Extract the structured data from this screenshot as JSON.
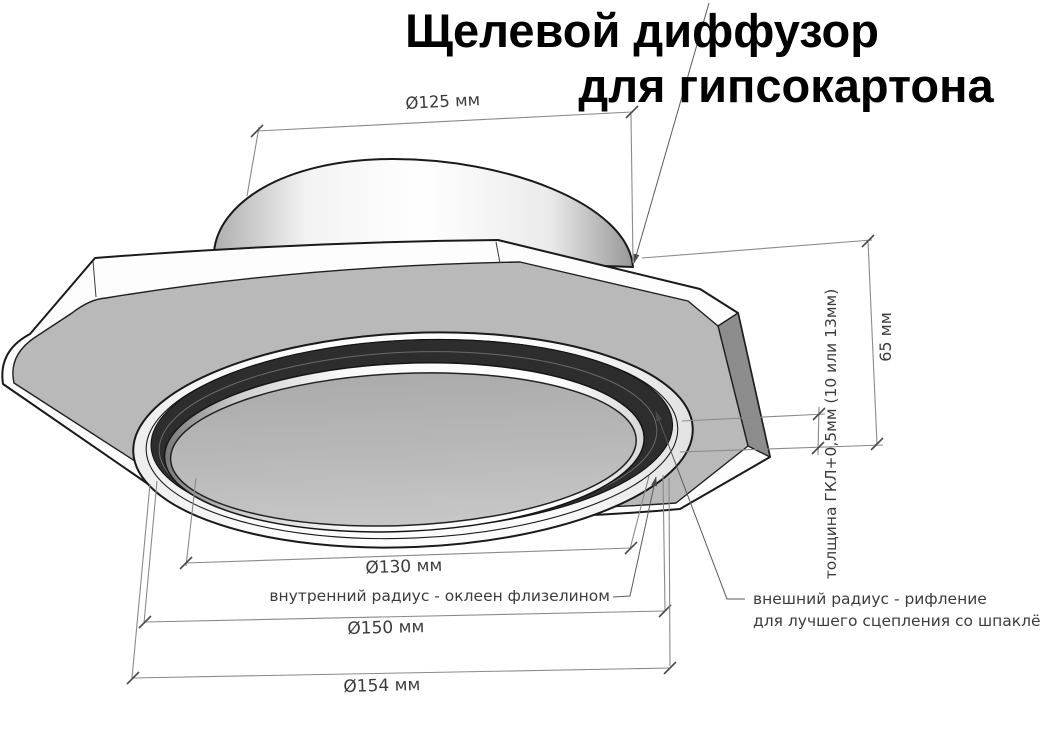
{
  "title": {
    "line1": "Щелевой диффузор",
    "line2": "для гипсокартона"
  },
  "dimensions": {
    "top_diameter": "Ø125 мм",
    "height": "65 мм",
    "panel_thickness": "толщина ГКЛ+0,5мм (10 или 13мм)",
    "inner_diameter": "Ø130 мм",
    "ring_diameter": "Ø150 мм",
    "outer_diameter": "Ø154 мм"
  },
  "annotations": {
    "inner_radius": "внутренний радиус - оклеен флизелином",
    "outer_radius_line1": "внешний радиус - рифление",
    "outer_radius_line2": "для лучшего сцепления со шпаклёвкой"
  },
  "colors": {
    "background": "#ffffff",
    "plate_face": "#b9b9b9",
    "slot_ring": "#2d2d2d",
    "bevel_face": "#8d8d8d",
    "outline": "#1a1a1a",
    "dim_line": "#8a8a8a",
    "dim_text": "#3c3c3c",
    "title_text": "#000000"
  }
}
